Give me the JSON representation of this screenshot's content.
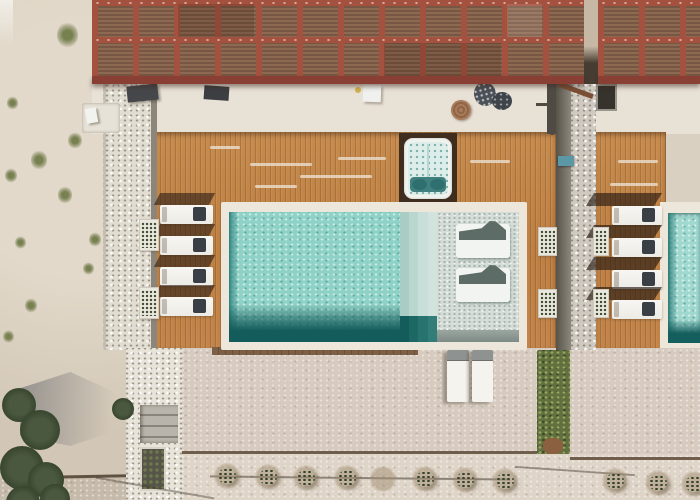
{
  "meta": {
    "description": "Aerial drone photo of a resort villa terrace: red slatted pergola roofs, timber deck, turquoise swimming pool with tanning ledge, hot tub, sun loungers and gravel garden",
    "width": 700,
    "height": 500
  },
  "palette": {
    "sand": "#dad0c1",
    "pebble_path": "#e4dfd4",
    "deck_wood": "#c28449",
    "pergola_frame": "#a5513f",
    "pergola_slats": "#81604a",
    "pool_water": "#8ed1c6",
    "pool_deep": "#135c5b",
    "tanning_ledge": "#d5ddd8",
    "coping": "#ede6da",
    "lounger_white": "#f5f4f0",
    "towel_dark": "#3a3f46",
    "patio_gravel": "#d7cbbf",
    "hedge_green": "#62703f",
    "hot_tub_seat": "#ddeeea",
    "accent_blue_step": "#5b97a4"
  },
  "scene": {
    "pergola_left": {
      "label": "slatted pergola roof (main villa)"
    },
    "pergola_right": {
      "label": "slatted pergola roof (neighbouring villa)"
    },
    "pool": {
      "label": "swimming pool with tanning ledge, steps and two in-water loungers"
    },
    "right_pool": {
      "label": "neighbouring swimming pool (edge of frame)"
    },
    "jacuzzi": {
      "label": "built-in hot tub in deck"
    },
    "deck": {
      "label": "timber pool deck"
    },
    "walkway": {
      "label": "white stone walkway with steps"
    },
    "left_lounger_rows": [
      205,
      236,
      267,
      297
    ],
    "right_lounger_rows": [
      206,
      238,
      270,
      300
    ],
    "in_pool_loungers": 2,
    "patio_loungers": 2,
    "planters": [
      [
        139,
        219,
        18,
        30
      ],
      [
        139,
        287,
        18,
        30
      ],
      [
        538,
        227,
        17,
        27
      ],
      [
        538,
        289,
        17,
        27
      ],
      [
        593,
        227,
        14,
        27
      ],
      [
        593,
        289,
        14,
        27
      ]
    ],
    "shrubs": [
      [
        227,
        476,
        1
      ],
      [
        268,
        477,
        1
      ],
      [
        306,
        478,
        1
      ],
      [
        347,
        478,
        1
      ],
      [
        383,
        479,
        0
      ],
      [
        425,
        479,
        1
      ],
      [
        465,
        480,
        1
      ],
      [
        505,
        481,
        1
      ],
      [
        615,
        481,
        1
      ],
      [
        658,
        483,
        1
      ],
      [
        694,
        484,
        1
      ]
    ],
    "sand_plants": [
      [
        66,
        22,
        26
      ],
      [
        12,
        96,
        14
      ],
      [
        38,
        150,
        20
      ],
      [
        74,
        132,
        17
      ],
      [
        10,
        168,
        15
      ],
      [
        64,
        186,
        18
      ],
      [
        94,
        232,
        15
      ],
      [
        20,
        236,
        13
      ],
      [
        88,
        262,
        13
      ],
      [
        30,
        298,
        15
      ],
      [
        8,
        330,
        13
      ]
    ],
    "tree_blobs": [
      [
        2,
        388,
        34
      ],
      [
        20,
        410,
        40
      ],
      [
        0,
        446,
        44
      ],
      [
        28,
        462,
        36
      ],
      [
        6,
        486,
        34
      ],
      [
        40,
        484,
        30
      ],
      [
        112,
        398,
        22
      ]
    ],
    "deck_streaks": [
      [
        250,
        163,
        62
      ],
      [
        300,
        175,
        72
      ],
      [
        338,
        157,
        48
      ],
      [
        255,
        185,
        42
      ],
      [
        470,
        160,
        40
      ],
      [
        210,
        146,
        30
      ],
      [
        618,
        160,
        40
      ],
      [
        610,
        183,
        48
      ]
    ]
  }
}
